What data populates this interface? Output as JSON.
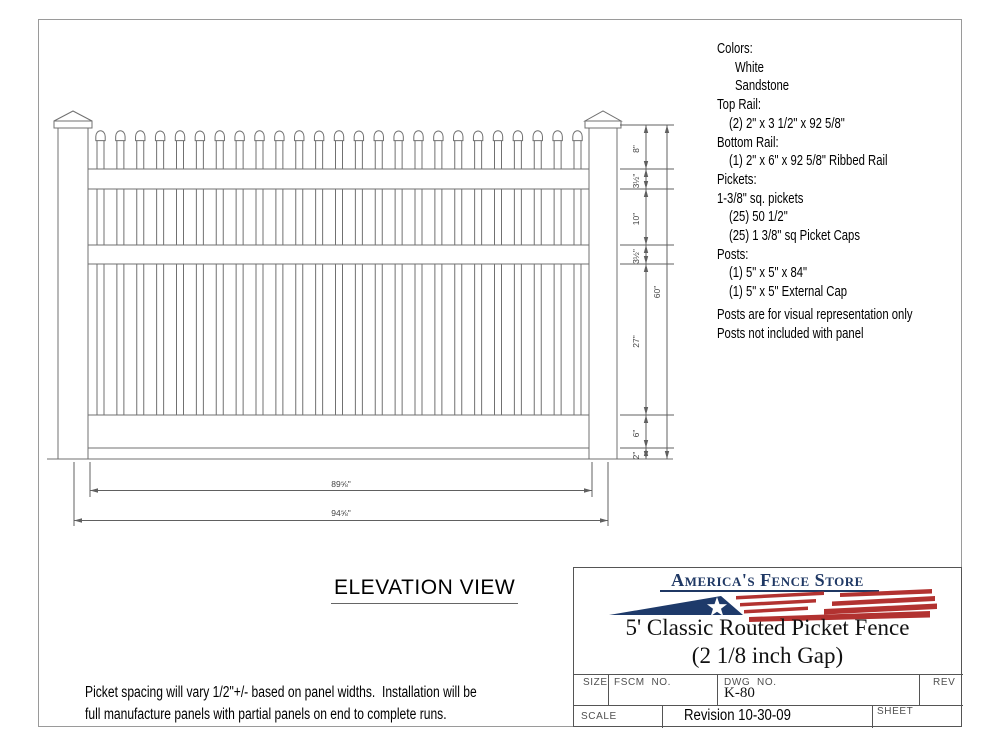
{
  "colors": {
    "drawing_line": "#707070",
    "dimension_line": "#606060",
    "brand_navy": "#1f3864",
    "flag_red": "#b23230"
  },
  "spec_list": {
    "lines": [
      {
        "text": "Colors:",
        "indent": 0
      },
      {
        "text": "White",
        "indent": 1
      },
      {
        "text": "Sandstone",
        "indent": 1
      },
      {
        "text": "Top Rail:",
        "indent": 0
      },
      {
        "text": "(2) 2\" x 3 1/2\" x 92 5/8\"",
        "indent": 2
      },
      {
        "text": "Bottom Rail:",
        "indent": 0
      },
      {
        "text": "(1) 2\" x 6\" x 92 5/8\" Ribbed Rail",
        "indent": 2
      },
      {
        "text": "Pickets:",
        "indent": 0
      },
      {
        "text": "1-3/8\" sq. pickets",
        "indent": 0
      },
      {
        "text": "(25) 50 1/2\"",
        "indent": 2
      },
      {
        "text": "(25) 1 3/8\" sq Picket Caps",
        "indent": 2
      },
      {
        "text": "Posts:",
        "indent": 0
      },
      {
        "text": "(1) 5\" x 5\" x 84\"",
        "indent": 2
      },
      {
        "text": "(1) 5\" x 5\" External Cap",
        "indent": 2
      },
      {
        "text": "Posts are for visual representation only",
        "indent": 0,
        "gap_before": true
      },
      {
        "text": "Posts not included with panel",
        "indent": 0
      }
    ]
  },
  "elevation": {
    "view_label": "ELEVATION VIEW",
    "picket_count": 25,
    "dim_segments": [
      "8\"",
      "3½\"",
      "10\"",
      "3½\"",
      "27\"",
      "6\"",
      "2\""
    ],
    "dim_total_height": "60\"",
    "dim_panel_width": "89⅝\"",
    "dim_overall_width": "94⅝\""
  },
  "note": {
    "lines": [
      "Picket spacing will vary 1/2\"+/- based on panel widths.  Installation will be",
      "full manufacture panels with partial panels on end to complete runs."
    ]
  },
  "title_block": {
    "brand": "America's Fence Store",
    "title_line1": "5' Classic Routed Picket Fence",
    "title_line2": "(2 1/8 inch Gap)",
    "size_label": "SIZE",
    "fscm_label": "FSCM  NO.",
    "dwg_label": "DWG  NO.",
    "dwg_no": "K-80",
    "rev_label": "REV",
    "scale_label": "SCALE",
    "revision": "Revision 10-30-09",
    "sheet_label": "SHEET"
  }
}
